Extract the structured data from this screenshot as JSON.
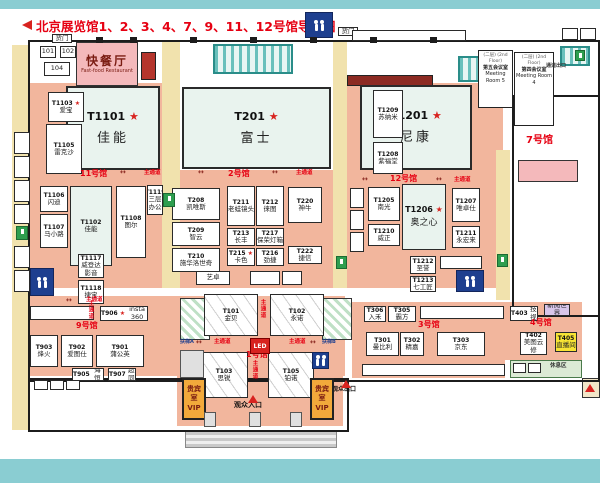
{
  "title": {
    "text": "北京展览馆1、2、3、4、7、9、11、12号馆导览图"
  },
  "colors": {
    "accent_red": "#e60012",
    "hall_floor": "#f2b69d",
    "corridor": "#f1e2ad",
    "restroom_blue": "#1e3f8f",
    "vip_orange": "#f2a93b",
    "teal_border": "#8acdd2"
  },
  "zones": [
    {
      "n": "corridor-left",
      "c": "yellow",
      "x": 12,
      "y": 45,
      "w": 16,
      "h": 385
    },
    {
      "n": "hall11-floor",
      "c": "salmon",
      "x": 28,
      "y": 83,
      "w": 134,
      "h": 205
    },
    {
      "n": "corridor-mid-left",
      "c": "yellow",
      "x": 162,
      "y": 42,
      "w": 18,
      "h": 246
    },
    {
      "n": "hall2-floor",
      "c": "salmon",
      "x": 180,
      "y": 170,
      "w": 153,
      "h": 118
    },
    {
      "n": "corridor-mid-right",
      "c": "yellow",
      "x": 333,
      "y": 42,
      "w": 14,
      "h": 246
    },
    {
      "n": "hall12-floor",
      "c": "salmon",
      "x": 347,
      "y": 83,
      "w": 156,
      "h": 205
    },
    {
      "n": "hall9-floor",
      "c": "salmon",
      "x": 28,
      "y": 296,
      "w": 317,
      "h": 80
    },
    {
      "n": "hall1-floor",
      "c": "salmon",
      "x": 177,
      "y": 296,
      "w": 166,
      "h": 130
    },
    {
      "n": "hall3-floor",
      "c": "salmon",
      "x": 352,
      "y": 302,
      "w": 153,
      "h": 76
    },
    {
      "n": "hall4-floor",
      "c": "salmon",
      "x": 505,
      "y": 302,
      "w": 77,
      "h": 58
    },
    {
      "n": "corridor-right",
      "c": "yellow",
      "x": 496,
      "y": 150,
      "w": 14,
      "h": 150
    },
    {
      "n": "maroon-block",
      "c": "maroon",
      "x": 347,
      "y": 75,
      "w": 84,
      "h": 9
    },
    {
      "n": "brick-block",
      "c": "brick",
      "x": 141,
      "y": 52,
      "w": 13,
      "h": 26
    },
    {
      "n": "glass-roof-center",
      "c": "tealgrid",
      "x": 213,
      "y": 44,
      "w": 76,
      "h": 26
    },
    {
      "n": "glass-roof-right",
      "c": "tealgrid",
      "x": 458,
      "y": 56,
      "w": 44,
      "h": 22
    },
    {
      "n": "glass-roof-corner",
      "c": "tealgrid",
      "x": 560,
      "y": 46,
      "w": 26,
      "h": 16
    },
    {
      "n": "escalator-a-shaft",
      "c": "hatch",
      "x": 180,
      "y": 298,
      "w": 28,
      "h": 40
    },
    {
      "n": "escalator-b-shaft",
      "c": "hatch",
      "x": 322,
      "y": 298,
      "w": 28,
      "h": 40
    },
    {
      "n": "rest-area-band",
      "c": "greenband",
      "x": 510,
      "y": 360,
      "w": 70,
      "h": 16
    },
    {
      "n": "entrance-steps",
      "c": "steps",
      "x": 185,
      "y": 430,
      "w": 150,
      "h": 16
    },
    {
      "n": "exit-structure",
      "c": "beige",
      "x": 582,
      "y": 378,
      "w": 16,
      "h": 18
    },
    {
      "n": "hall7-stage",
      "c": "pinkb",
      "x": 518,
      "y": 160,
      "w": 58,
      "h": 20
    }
  ],
  "walls": [
    {
      "n": "outer-wall",
      "x": 28,
      "y": 40,
      "w": 568,
      "h": 338
    },
    {
      "n": "south-extension-wall",
      "x": 28,
      "y": 378,
      "w": 317,
      "h": 50
    },
    {
      "n": "hall7-wall",
      "x": 512,
      "y": 95,
      "w": 84,
      "h": 218
    }
  ],
  "booths": [
    {
      "id": "T1101",
      "nm": "佳能",
      "star": 1,
      "x": 66,
      "y": 86,
      "w": 94,
      "h": 84,
      "v": "big"
    },
    {
      "id": "T201",
      "nm": "富士",
      "star": 1,
      "x": 182,
      "y": 87,
      "w": 149,
      "h": 82,
      "v": "big"
    },
    {
      "id": "T1201",
      "nm": "尼康",
      "star": 1,
      "x": 360,
      "y": 85,
      "w": 112,
      "h": 85,
      "v": "big"
    },
    {
      "id": "T1206",
      "nm": "奥之心",
      "star": 1,
      "x": 402,
      "y": 184,
      "w": 44,
      "h": 66,
      "v": "med"
    },
    {
      "id": "快餐厅",
      "nm": "Fast-food Restaurant",
      "x": 76,
      "y": 42,
      "w": 62,
      "h": 44,
      "v": "resto"
    },
    {
      "id": "T1103",
      "nm": "爱宝",
      "star": 1,
      "x": 48,
      "y": 92,
      "w": 36,
      "h": 30
    },
    {
      "id": "T1105",
      "nm": "雷克沙",
      "x": 46,
      "y": 124,
      "w": 36,
      "h": 50
    },
    {
      "id": "T1106",
      "nm": "闪迪",
      "x": 40,
      "y": 186,
      "w": 28,
      "h": 26
    },
    {
      "id": "T1107",
      "nm": "马小路",
      "x": 40,
      "y": 214,
      "w": 28,
      "h": 34
    },
    {
      "id": "T1102",
      "nm": "佳能",
      "x": 70,
      "y": 186,
      "w": 42,
      "h": 80,
      "v": "pale"
    },
    {
      "id": "T1108",
      "nm": "图尔",
      "x": 116,
      "y": 186,
      "w": 30,
      "h": 72
    },
    {
      "id": "T1119",
      "nm": "三层办公",
      "x": 147,
      "y": 185,
      "w": 16,
      "h": 30
    },
    {
      "id": "T1117",
      "nm": "威登达影音",
      "x": 78,
      "y": 254,
      "w": 26,
      "h": 24
    },
    {
      "id": "T1118",
      "nm": "捷宝",
      "x": 78,
      "y": 280,
      "w": 26,
      "h": 24
    },
    {
      "id": "T208",
      "nm": "凯唯斯",
      "x": 172,
      "y": 188,
      "w": 48,
      "h": 32
    },
    {
      "id": "T209",
      "nm": "智云",
      "x": 172,
      "y": 222,
      "w": 48,
      "h": 24
    },
    {
      "id": "T210",
      "nm": "施华洛世奇",
      "x": 172,
      "y": 248,
      "w": 48,
      "h": 24
    },
    {
      "id": "T211",
      "nm": "老蛙镜头",
      "x": 227,
      "y": 186,
      "w": 28,
      "h": 40
    },
    {
      "id": "T212",
      "nm": "徕图",
      "x": 256,
      "y": 186,
      "w": 28,
      "h": 40
    },
    {
      "id": "T213",
      "nm": "长丰",
      "x": 227,
      "y": 228,
      "w": 28,
      "h": 18
    },
    {
      "id": "T217",
      "nm": "保荣灯箱",
      "x": 256,
      "y": 228,
      "w": 28,
      "h": 18
    },
    {
      "id": "T215",
      "nm": "卡色",
      "star": 1,
      "x": 227,
      "y": 248,
      "w": 28,
      "h": 18
    },
    {
      "id": "T216",
      "nm": "劲捷",
      "x": 256,
      "y": 248,
      "w": 28,
      "h": 18
    },
    {
      "id": "T220",
      "nm": "神牛",
      "x": 288,
      "y": 187,
      "w": 34,
      "h": 36
    },
    {
      "id": "T222",
      "nm": "捷信",
      "x": 288,
      "y": 246,
      "w": 34,
      "h": 18
    },
    {
      "nm": "艺卓",
      "x": 196,
      "y": 271,
      "w": 34,
      "h": 14
    },
    {
      "x": 250,
      "y": 271,
      "w": 30,
      "h": 14
    },
    {
      "x": 282,
      "y": 271,
      "w": 20,
      "h": 14
    },
    {
      "id": "T1209",
      "nm": "苏纳米",
      "x": 373,
      "y": 90,
      "w": 30,
      "h": 48
    },
    {
      "id": "T1208",
      "nm": "紫福堂",
      "x": 373,
      "y": 142,
      "w": 30,
      "h": 32
    },
    {
      "id": "T1205",
      "nm": "南光",
      "x": 368,
      "y": 187,
      "w": 32,
      "h": 34
    },
    {
      "id": "T1210",
      "nm": "威正",
      "x": 368,
      "y": 224,
      "w": 32,
      "h": 22
    },
    {
      "id": "T1207",
      "nm": "唯卓仕",
      "x": 452,
      "y": 188,
      "w": 28,
      "h": 34
    },
    {
      "id": "T1211",
      "nm": "永宏来",
      "x": 452,
      "y": 226,
      "w": 28,
      "h": 22
    },
    {
      "id": "T1212",
      "nm": "至誉",
      "x": 410,
      "y": 256,
      "w": 26,
      "h": 18
    },
    {
      "id": "T1213",
      "nm": "七工匠",
      "x": 410,
      "y": 276,
      "w": 26,
      "h": 16
    },
    {
      "x": 440,
      "y": 256,
      "w": 42,
      "h": 13
    },
    {
      "x": 350,
      "y": 188,
      "w": 14,
      "h": 20
    },
    {
      "x": 350,
      "y": 210,
      "w": 14,
      "h": 20
    },
    {
      "x": 350,
      "y": 232,
      "w": 14,
      "h": 20
    },
    {
      "id": "T906",
      "nm": "insta 360",
      "star": 1,
      "x": 100,
      "y": 306,
      "w": 48,
      "h": 15,
      "v": "row"
    },
    {
      "x": 30,
      "y": 306,
      "w": 64,
      "h": 14
    },
    {
      "id": "T903",
      "nm": "烽火",
      "x": 30,
      "y": 335,
      "w": 28,
      "h": 32
    },
    {
      "id": "T902",
      "nm": "爱图仕",
      "x": 61,
      "y": 335,
      "w": 32,
      "h": 32
    },
    {
      "id": "T901",
      "nm": "蒲公英",
      "x": 96,
      "y": 335,
      "w": 48,
      "h": 32
    },
    {
      "id": "T905",
      "nm": "上海恒力",
      "x": 72,
      "y": 368,
      "w": 32,
      "h": 13,
      "v": "row"
    },
    {
      "id": "T907",
      "nm": "超同",
      "x": 108,
      "y": 368,
      "w": 28,
      "h": 13,
      "v": "row"
    },
    {
      "id": "T101",
      "nm": "金贝",
      "x": 204,
      "y": 294,
      "w": 54,
      "h": 42,
      "v": "truss"
    },
    {
      "id": "T102",
      "nm": "永诺",
      "x": 270,
      "y": 294,
      "w": 54,
      "h": 42,
      "v": "truss"
    },
    {
      "id": "T103",
      "nm": "思锐",
      "x": 200,
      "y": 352,
      "w": 48,
      "h": 46,
      "v": "truss"
    },
    {
      "id": "T105",
      "nm": "铂诺",
      "x": 268,
      "y": 352,
      "w": 46,
      "h": 46,
      "v": "truss"
    },
    {
      "id": "T306",
      "nm": "入禾",
      "x": 364,
      "y": 306,
      "w": 22,
      "h": 16
    },
    {
      "id": "T305",
      "nm": "霸方",
      "x": 388,
      "y": 306,
      "w": 28,
      "h": 16
    },
    {
      "x": 420,
      "y": 306,
      "w": 84,
      "h": 13
    },
    {
      "id": "T301",
      "nm": "曼比利",
      "x": 366,
      "y": 332,
      "w": 33,
      "h": 24
    },
    {
      "id": "T302",
      "nm": "精嘉",
      "x": 400,
      "y": 332,
      "w": 24,
      "h": 24
    },
    {
      "id": "T303",
      "nm": "京东",
      "x": 437,
      "y": 332,
      "w": 48,
      "h": 24
    },
    {
      "x": 362,
      "y": 364,
      "w": 143,
      "h": 12
    },
    {
      "id": "T403",
      "nm": "科技视讯",
      "x": 510,
      "y": 306,
      "w": 28,
      "h": 15,
      "v": "row"
    },
    {
      "nm": "新阅世界",
      "x": 544,
      "y": 304,
      "w": 26,
      "h": 12,
      "v": "lav"
    },
    {
      "id": "T402",
      "nm": "美图云修",
      "x": 520,
      "y": 332,
      "w": 27,
      "h": 23
    },
    {
      "id": "T405",
      "nm": "直播间",
      "x": 555,
      "y": 332,
      "w": 22,
      "h": 20,
      "v": "ylw"
    },
    {
      "x": 513,
      "y": 363,
      "w": 13,
      "h": 10
    },
    {
      "x": 528,
      "y": 363,
      "w": 13,
      "h": 10
    },
    {
      "nm": "101",
      "x": 40,
      "y": 46,
      "w": 16,
      "h": 12
    },
    {
      "nm": "102",
      "x": 60,
      "y": 46,
      "w": 16,
      "h": 12
    },
    {
      "nm": "104",
      "x": 44,
      "y": 62,
      "w": 26,
      "h": 14
    },
    {
      "nm": "货门",
      "x": 52,
      "y": 34,
      "w": 20,
      "h": 9
    },
    {
      "nm": "货门",
      "x": 338,
      "y": 27,
      "w": 20,
      "h": 9
    },
    {
      "x": 352,
      "y": 30,
      "w": 114,
      "h": 11
    },
    {
      "x": 562,
      "y": 28,
      "w": 16,
      "h": 12
    },
    {
      "x": 580,
      "y": 28,
      "w": 16,
      "h": 12
    },
    {
      "x": 14,
      "y": 132,
      "w": 16,
      "h": 22
    },
    {
      "x": 14,
      "y": 156,
      "w": 16,
      "h": 22
    },
    {
      "x": 14,
      "y": 180,
      "w": 16,
      "h": 22
    },
    {
      "x": 14,
      "y": 204,
      "w": 16,
      "h": 20
    },
    {
      "x": 14,
      "y": 246,
      "w": 16,
      "h": 22
    },
    {
      "x": 14,
      "y": 270,
      "w": 16,
      "h": 22
    },
    {
      "x": 34,
      "y": 380,
      "w": 14,
      "h": 10
    },
    {
      "x": 50,
      "y": 380,
      "w": 14,
      "h": 10
    },
    {
      "x": 66,
      "y": 380,
      "w": 14,
      "h": 10
    }
  ],
  "rooms": [
    {
      "n": "meeting-room-5",
      "lines": [
        "(二层) (2nd Floor)",
        "第五会议室",
        "Meeting Room 5"
      ],
      "x": 478,
      "y": 50,
      "w": 35,
      "h": 58
    },
    {
      "n": "meeting-room-4",
      "lines": [
        "(二层) (2nd Floor)",
        "第四会议室",
        "Meeting Room 4"
      ],
      "x": 514,
      "y": 52,
      "w": 40,
      "h": 74
    }
  ],
  "labels": [
    {
      "n": "hall7-label",
      "t": "7号馆",
      "x": 526,
      "y": 136,
      "s": 10
    },
    {
      "n": "hall11-label",
      "t": "11号馆",
      "x": 80,
      "y": 170,
      "s": 8
    },
    {
      "n": "hall2-label",
      "t": "2号馆",
      "x": 228,
      "y": 170,
      "s": 8
    },
    {
      "n": "hall12-label",
      "t": "12号馆",
      "x": 390,
      "y": 175,
      "s": 8
    },
    {
      "n": "hall9-label",
      "t": "9号馆",
      "x": 76,
      "y": 322,
      "s": 8
    },
    {
      "n": "hall1-label",
      "t": "1号馆",
      "x": 246,
      "y": 351,
      "s": 8
    },
    {
      "n": "hall3-label",
      "t": "3号馆",
      "x": 418,
      "y": 321,
      "s": 8
    },
    {
      "n": "hall4-label",
      "t": "4号馆",
      "x": 530,
      "y": 319,
      "s": 8
    },
    {
      "n": "main-aisle-label",
      "t": "主通道",
      "x": 144,
      "y": 171,
      "s": 5.5
    },
    {
      "n": "main-aisle-label",
      "t": "主通道",
      "x": 296,
      "y": 171,
      "s": 5.5
    },
    {
      "n": "main-aisle-label",
      "t": "主通道",
      "x": 454,
      "y": 178,
      "s": 5.5
    },
    {
      "n": "main-aisle-label",
      "t": "主通道",
      "x": 214,
      "y": 340,
      "s": 5.5
    },
    {
      "n": "main-aisle-label",
      "t": "主通道",
      "x": 289,
      "y": 340,
      "s": 5.5
    },
    {
      "n": "main-aisle-label",
      "t": "主通道",
      "x": 86,
      "y": 298,
      "s": 5.5
    },
    {
      "n": "main-aisle-label",
      "t": "主通道",
      "x": 259,
      "y": 299,
      "s": 5.5,
      "v": 1
    },
    {
      "n": "main-aisle-label",
      "t": "主通道",
      "x": 251,
      "y": 360,
      "s": 5.5,
      "v": 1
    },
    {
      "n": "main-aisle-label",
      "t": "主通道",
      "x": 87,
      "y": 300,
      "s": 5.5,
      "v": 1
    },
    {
      "n": "aisle-arrow",
      "t": "↔",
      "x": 120,
      "y": 169,
      "s": 7,
      "c": "#8c2a22"
    },
    {
      "n": "aisle-arrow",
      "t": "↔",
      "x": 198,
      "y": 169,
      "s": 7,
      "c": "#8c2a22"
    },
    {
      "n": "aisle-arrow",
      "t": "↔",
      "x": 272,
      "y": 169,
      "s": 7,
      "c": "#8c2a22"
    },
    {
      "n": "aisle-arrow",
      "t": "↔",
      "x": 362,
      "y": 176,
      "s": 7,
      "c": "#8c2a22"
    },
    {
      "n": "aisle-arrow",
      "t": "↔",
      "x": 436,
      "y": 176,
      "s": 7,
      "c": "#8c2a22"
    },
    {
      "n": "aisle-arrow",
      "t": "↔",
      "x": 196,
      "y": 339,
      "s": 7,
      "c": "#8c2a22"
    },
    {
      "n": "aisle-arrow",
      "t": "↔",
      "x": 310,
      "y": 339,
      "s": 7,
      "c": "#8c2a22"
    },
    {
      "n": "aisle-arrow",
      "t": "↔",
      "x": 66,
      "y": 297,
      "s": 7,
      "c": "#8c2a22"
    },
    {
      "n": "escalator-a-label",
      "t": "扶梯A",
      "x": 180,
      "y": 340,
      "s": 5,
      "c": "#1e3f8f"
    },
    {
      "n": "escalator-b-label",
      "t": "扶梯B",
      "x": 322,
      "y": 340,
      "s": 5,
      "c": "#1e3f8f"
    },
    {
      "n": "visitor-entrance-label",
      "t": "观众入口",
      "x": 234,
      "y": 402,
      "s": 7,
      "c": "#111"
    },
    {
      "n": "visitor-exit-label",
      "t": "观众出口",
      "x": 332,
      "y": 387,
      "s": 6,
      "c": "#111"
    },
    {
      "n": "rest-area-label",
      "t": "休息区",
      "x": 550,
      "y": 364,
      "s": 5.5,
      "c": "#333"
    },
    {
      "n": "passage-exit-label",
      "t": "通道出口",
      "x": 546,
      "y": 64,
      "s": 5,
      "c": "#333"
    }
  ],
  "markers": [
    {
      "n": "entrance-arrow-icon",
      "x": 248,
      "y": 395
    },
    {
      "n": "exit-arrow-icon",
      "x": 341,
      "y": 380
    },
    {
      "n": "exit-arrow-icon",
      "x": 585,
      "y": 384
    }
  ],
  "restrooms": [
    {
      "x": 305,
      "y": 12,
      "w": 26,
      "h": 24
    },
    {
      "x": 30,
      "y": 268,
      "w": 22,
      "h": 26
    },
    {
      "x": 456,
      "y": 270,
      "w": 26,
      "h": 20
    },
    {
      "x": 312,
      "y": 352,
      "w": 15,
      "h": 15
    }
  ],
  "exits": [
    {
      "x": 16,
      "y": 226,
      "w": 10,
      "h": 12
    },
    {
      "x": 163,
      "y": 193,
      "w": 10,
      "h": 12
    },
    {
      "x": 336,
      "y": 256,
      "w": 9,
      "h": 11
    },
    {
      "x": 497,
      "y": 254,
      "w": 9,
      "h": 11
    },
    {
      "x": 575,
      "y": 50,
      "w": 8,
      "h": 9
    }
  ],
  "vips": [
    {
      "lines": [
        "贵宾室",
        "VIP"
      ],
      "x": 182,
      "y": 378,
      "w": 24,
      "h": 42
    },
    {
      "lines": [
        "贵宾室",
        "VIP"
      ],
      "x": 310,
      "y": 378,
      "w": 24,
      "h": 42
    }
  ],
  "led": {
    "t": "LED",
    "x": 250,
    "y": 338,
    "w": 18,
    "h": 14
  },
  "pillars": [
    {
      "x": 96,
      "y": 37
    },
    {
      "x": 130,
      "y": 37
    },
    {
      "x": 190,
      "y": 37
    },
    {
      "x": 250,
      "y": 37
    },
    {
      "x": 310,
      "y": 37
    },
    {
      "x": 370,
      "y": 37
    },
    {
      "x": 430,
      "y": 37
    }
  ],
  "posts": [
    {
      "x": 204,
      "y": 412
    },
    {
      "x": 249,
      "y": 412
    },
    {
      "x": 290,
      "y": 412
    }
  ],
  "gray_boxes": [
    {
      "n": "service-desk",
      "x": 180,
      "y": 350,
      "w": 22,
      "h": 26
    }
  ]
}
